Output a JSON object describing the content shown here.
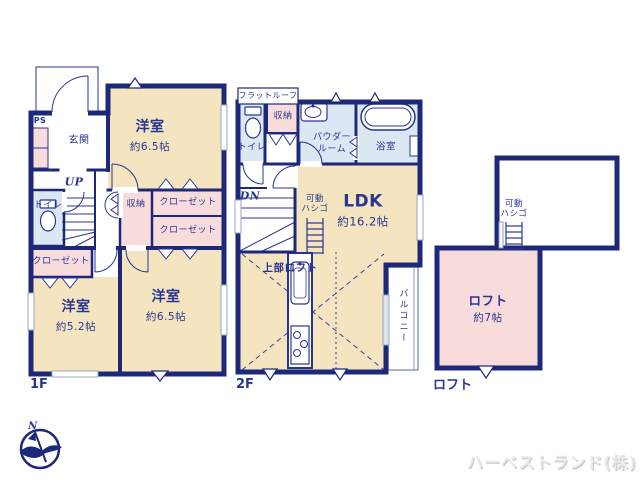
{
  "floor1": {
    "floor_label": "1F",
    "ps": "PS",
    "entrance": "玄関",
    "bedroom_top": {
      "name": "洋室",
      "size": "約6.5帖"
    },
    "stairs": "UP",
    "toilet": "トイレ",
    "storage": "収納",
    "closet_a": "クローゼット",
    "closet_b": "クローゼット",
    "closet_c": "クローゼット",
    "bedroom_left": {
      "name": "洋室",
      "size": "約5.2帖"
    },
    "bedroom_right": {
      "name": "洋室",
      "size": "約6.5帖"
    }
  },
  "floor2": {
    "floor_label": "2F",
    "flat_roof": "フラットルーフ",
    "toilet": "トイレ",
    "storage": "収納",
    "powder_room_line1": "パウダー",
    "powder_room_line2": "ルーム",
    "bathroom": "浴室",
    "stairs": "DN",
    "ladder_line1": "可動",
    "ladder_line2": "ハシゴ",
    "ldk": {
      "name": "LDK",
      "size": "約16.2帖"
    },
    "upper_loft": "上部ロフト",
    "balcony": "バルコニー"
  },
  "loft": {
    "floor_label": "ロフト",
    "ladder_line1": "可動",
    "ladder_line2": "ハシゴ",
    "room": {
      "name": "ロフト",
      "size": "約7帖"
    }
  },
  "compass": {
    "north": "N"
  },
  "watermark": "ハーベストランド(株)",
  "colors": {
    "wall": "#1e2878",
    "text": "#283593",
    "room_cream": "#f4e4c0",
    "room_pink": "#f8dbdb",
    "room_blue": "#dbe7f3",
    "window_gray": "#9aa6c6"
  }
}
